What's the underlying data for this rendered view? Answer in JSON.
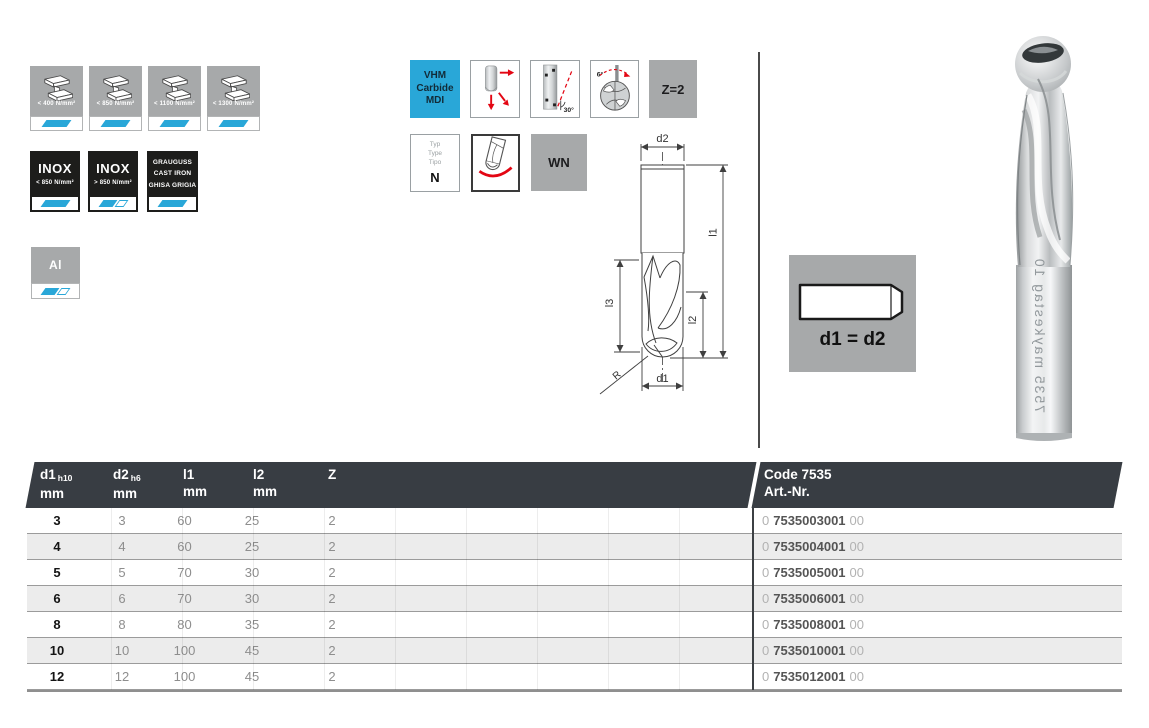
{
  "colors": {
    "accent_blue": "#29a7d8",
    "icon_gray": "#a7a9aa",
    "icon_black": "#1d1d1b",
    "table_header_dark": "#383d43",
    "row_alt": "#ececec",
    "arrow_red": "#e30613"
  },
  "materials": {
    "steel": [
      {
        "label": "< 400 N/mm²"
      },
      {
        "label": "< 850 N/mm²"
      },
      {
        "label": "< 1100 N/mm²"
      },
      {
        "label": "< 1300 N/mm²"
      }
    ],
    "inox": [
      {
        "title": "INOX",
        "label": "< 850 N/mm²"
      },
      {
        "title": "INOX",
        "label": "> 850 N/mm²"
      }
    ],
    "cast_iron": {
      "line1": "GRAUGUSS",
      "line2": "CAST IRON",
      "line3": "GHISA GRIGIA"
    },
    "aluminium": {
      "title": "Al"
    }
  },
  "features": {
    "vhm": {
      "line1": "VHM",
      "line2": "Carbide",
      "line3": "MDI"
    },
    "helix_label": "30°",
    "angle_label": "6°",
    "z_label": "Z=2",
    "type": {
      "l1": "Typ",
      "l2": "Type",
      "l3": "Tipo",
      "value": "N"
    },
    "wn_label": "WN",
    "shank_label": "d1 = d2"
  },
  "drawing": {
    "d2": "d2",
    "l1": "l1",
    "l2": "l2",
    "l3": "l3",
    "r": "R",
    "d1": "d1"
  },
  "photo": {
    "etch_text": "7535 maykestag 10"
  },
  "table": {
    "header": {
      "cols": [
        {
          "name": "d1",
          "tol": "h10",
          "unit": "mm"
        },
        {
          "name": "d2",
          "tol": "h6",
          "unit": "mm"
        },
        {
          "name": "l1",
          "tol": "",
          "unit": "mm"
        },
        {
          "name": "l2",
          "tol": "",
          "unit": "mm"
        },
        {
          "name": "Z",
          "tol": "",
          "unit": ""
        }
      ],
      "code_line1": "Code 7535",
      "code_line2": "Art.-Nr."
    },
    "rows": [
      {
        "d1": "3",
        "d2": "3",
        "l1": "60",
        "l2": "25",
        "z": "2",
        "p": "0",
        "art": "7535003001",
        "s": "00"
      },
      {
        "d1": "4",
        "d2": "4",
        "l1": "60",
        "l2": "25",
        "z": "2",
        "p": "0",
        "art": "7535004001",
        "s": "00"
      },
      {
        "d1": "5",
        "d2": "5",
        "l1": "70",
        "l2": "30",
        "z": "2",
        "p": "0",
        "art": "7535005001",
        "s": "00"
      },
      {
        "d1": "6",
        "d2": "6",
        "l1": "70",
        "l2": "30",
        "z": "2",
        "p": "0",
        "art": "7535006001",
        "s": "00"
      },
      {
        "d1": "8",
        "d2": "8",
        "l1": "80",
        "l2": "35",
        "z": "2",
        "p": "0",
        "art": "7535008001",
        "s": "00"
      },
      {
        "d1": "10",
        "d2": "10",
        "l1": "100",
        "l2": "45",
        "z": "2",
        "p": "0",
        "art": "7535010001",
        "s": "00"
      },
      {
        "d1": "12",
        "d2": "12",
        "l1": "100",
        "l2": "45",
        "z": "2",
        "p": "0",
        "art": "7535012001",
        "s": "00"
      }
    ]
  }
}
